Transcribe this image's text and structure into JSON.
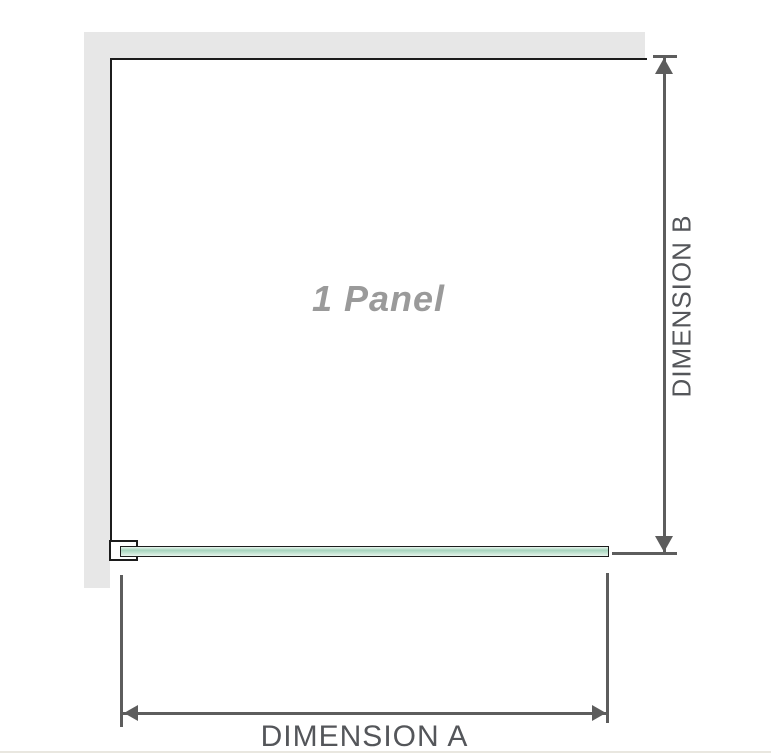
{
  "diagram": {
    "panel_label": "1 Panel",
    "dimension_a": {
      "label": "DIMENSION A",
      "orientation": "horizontal"
    },
    "dimension_b": {
      "label": "DIMENSION B",
      "orientation": "vertical"
    },
    "colors": {
      "wall": "#e7e7e7",
      "outline": "#1c1c1c",
      "dimension": "#5d5d5d",
      "dim_text": "#54565a",
      "label_gray": "#9a9a9a",
      "glass_light": "#e9f5ee",
      "glass_mid": "#a6d4bd",
      "glass_soft": "#cde8d9",
      "divider": "#e9e7e0"
    }
  }
}
